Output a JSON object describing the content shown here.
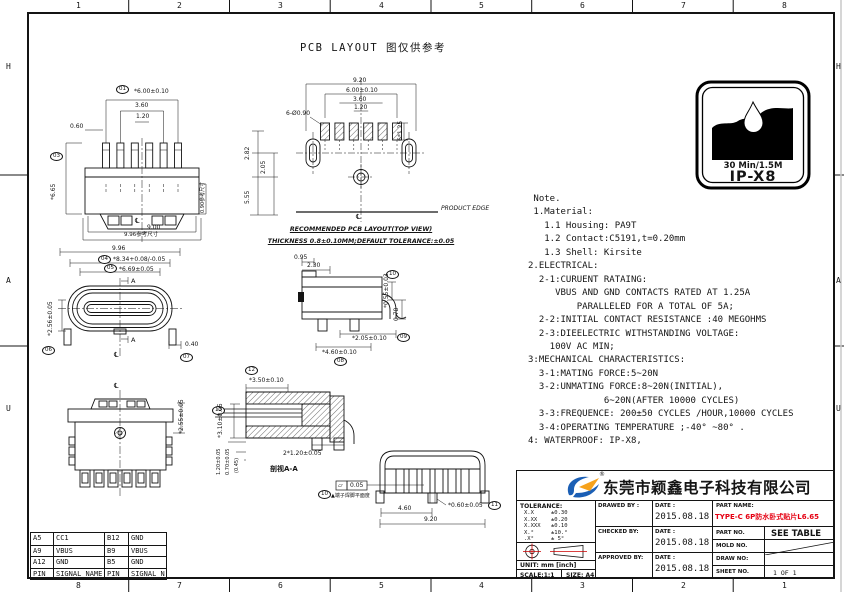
{
  "frame": {
    "top_numbers": [
      "1",
      "2",
      "3",
      "4",
      "5",
      "6",
      "7",
      "8"
    ],
    "bottom_numbers": [
      "8",
      "7",
      "6",
      "5",
      "4",
      "3",
      "2",
      "1"
    ],
    "left_letters": [
      "H",
      "A",
      "U"
    ],
    "right_letters": [
      "H",
      "A",
      "U"
    ]
  },
  "title": "PCB LAYOUT 图仅供参考",
  "badge": {
    "line1": "30 Min/1.5M",
    "line2": "IP-X8"
  },
  "notes": {
    "lines": [
      " Note.",
      " 1.Material:",
      "   1.1 Housing: PA9T",
      "   1.2 Contact:C5191,t=0.20mm",
      "   1.3 Shell: Kirsite",
      "2.ELECTRICAL:",
      "  2-1:CURUENT RATAING:",
      "     VBUS AND GND CONTACTS RATED AT 1.25A",
      "         PARALLELED FOR A TOTAL OF 5A;",
      "  2-2:INITIAL CONTACT RESISTANCE :40 MEGOHMS",
      "  2-3:DIEELECTRIC WITHSTANDING VOLTAGE:",
      "    100V AC MIN;",
      "3:MECHANICAL CHARACTERISTICS:",
      "  3-1:MATING FORCE:5~20N",
      "  3-2:UNMATING FORCE:8~20N(INITIAL),",
      "              6~20N(AFTER 10000 CYCLES)",
      "  3-3:FREQUENCE: 200±50 CYCLES /HOUR,10000 CYCLES",
      "  3-4:OPERATING TEMPERATURE ;-40° ~80° .",
      "4: WATERPROOF: IP-X8,"
    ]
  },
  "balloons": {
    "b01": "01",
    "b03": "03",
    "b04": "04",
    "b05": "05",
    "b06": "06",
    "b07": "07",
    "b08": "08",
    "b09": "09",
    "b10": "10",
    "b11": "11",
    "b12": "12",
    "b13": "13"
  },
  "views": {
    "top": {
      "w": "*6.00±0.10",
      "p1": "3.60",
      "p2": "1.20",
      "p3": "0.60",
      "len": "*6.65",
      "ref_r": "0.90参考尺寸",
      "w2": "9.00",
      "ref_b": "9.96参考尺寸",
      "cl": "℄"
    },
    "pcb": {
      "w": "9.20",
      "w2": "6.00±0.10",
      "p1": "3.60",
      "p2": "1.20",
      "holes": "6-Ø0.90",
      "pads": "6*1.25",
      "v1": "2.82",
      "v2": "2.05",
      "v3": "5.55",
      "edge": "PRODUCT EDGE",
      "cap1": "RECOMMENDED PCB LAYOUT(TOP VIEW)",
      "cap2": "THICKNESS 0.8±0.10MM;DEFAULT TOLERANCE:±0.05",
      "cl": "℄"
    },
    "front": {
      "w": "9.96",
      "d1": "*8.34+0.08/-0.05",
      "d2": "*6.69±0.05",
      "sa": "A",
      "d3": "0.40",
      "d4": "*2.56±0.05",
      "cl": "℄"
    },
    "side": {
      "d1": "0.95",
      "d2": "2.30",
      "d3": "*0.55±0.03",
      "d4": "0.78",
      "d5": "*2.05±0.10",
      "d6": "*4.60±0.10"
    },
    "section": {
      "d1": "*3.50±0.10",
      "d2": "*3.10±0.05",
      "d3": "1.20±0.05",
      "d4": "0.70±0.05",
      "d5": "(0.45)",
      "d6": "2*1.20±0.05",
      "cap": "剖视A-A"
    },
    "bottom": {
      "d1": "*2.55±0.05",
      "cl": "℄"
    },
    "rear": {
      "d1": "4.60",
      "d2": "9.20",
      "d3": "*0.60±0.05",
      "flat_sym": "▱",
      "flat_val": "0.05",
      "note": "▲端子焊脚平面度"
    }
  },
  "pin_table": {
    "header": [
      "PIN",
      "SIGNAL NAME",
      "PIN",
      "SIGNAL NAME"
    ],
    "rows": [
      [
        "A5",
        "CC1",
        "B12",
        "GND"
      ],
      [
        "A9",
        "VBUS",
        "B9",
        "VBUS"
      ],
      [
        "A12",
        "GND",
        "B5",
        "GND"
      ]
    ]
  },
  "title_block": {
    "company": "东莞市颖鑫电子科技有限公司",
    "registered": "®",
    "tolerance_title": "TOLERANCE:",
    "tolerance_rows": [
      [
        "X.X",
        "±0.30"
      ],
      [
        "X.XX",
        "±0.20"
      ],
      [
        "X.XXX",
        "±0.10"
      ],
      [
        "X.°",
        "±10.°"
      ],
      [
        ".X°",
        "± 5°"
      ]
    ],
    "unit_label": "UNIT: mm [inch]",
    "scale_label": "SCALE:1:1",
    "size_label": "SIZE: A4",
    "drawed_by": "DRAWED BY :",
    "checked_by": "CHECKED BY:",
    "approved_by": "APPROVED BY:",
    "date_label": "DATE :",
    "dates": [
      "2015.08.18",
      "2015.08.18",
      "2015.08.18"
    ],
    "part_name_label": "PART NAME:",
    "part_name": "TYPE-C 6P防水卧式贴片L6.65",
    "part_no_label": "PART NO.",
    "part_no": "SEE TABLE",
    "mold_no_label": "MOLD NO.",
    "draw_no_label": "DRAW NO:",
    "sheet_no_label": "SHEET NO.",
    "sheet_no": "1 OF 1"
  },
  "colors": {
    "accent_red": "#e50012",
    "logo_blue": "#1b5fb5",
    "logo_orange": "#f6a21c",
    "line": "#141414"
  }
}
